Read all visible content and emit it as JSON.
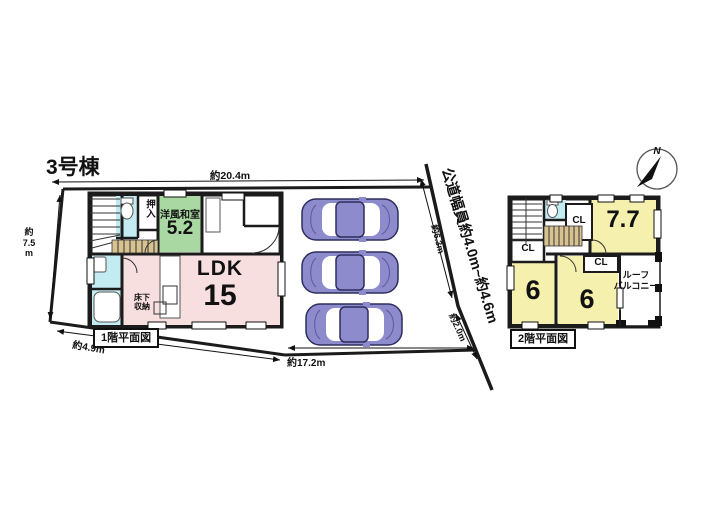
{
  "title": "3号棟",
  "compass": {
    "north": "N"
  },
  "site_dims": {
    "top": "約20.4m",
    "left_l1": "約",
    "left_l2": "7.5",
    "left_l3": "m",
    "bottom_left": "約4.9m",
    "bottom": "約17.2m",
    "road_upper": "約6.3m",
    "road_lower": "約2.0m",
    "road_width": "公道幅員約4.0m~約4.6m"
  },
  "floor1": {
    "caption": "1階平面図",
    "ldk_label": "LDK",
    "ldk_size": "15",
    "jroom_label": "洋風和室",
    "jroom_size": "5.2",
    "oshiire": "押入",
    "underfloor_l1": "床下",
    "underfloor_l2": "収納"
  },
  "floor2": {
    "caption": "2階平面図",
    "room_77": "7.7",
    "room_6a": "6",
    "room_6b": "6",
    "cl_a": "CL",
    "cl_b": "CL",
    "cl_c": "CL",
    "balcony_l1": "ルーフ",
    "balcony_l2": "バルコニー"
  },
  "colors": {
    "wall": "#1b1b1b",
    "room_green": "#a9d8a2",
    "room_pink": "#f8dfdf",
    "room_yellow": "#f5f0ae",
    "water_cyan": "#c2ebf2",
    "stair_tan": "#d8c290",
    "car_body": "#8d8bcb"
  }
}
